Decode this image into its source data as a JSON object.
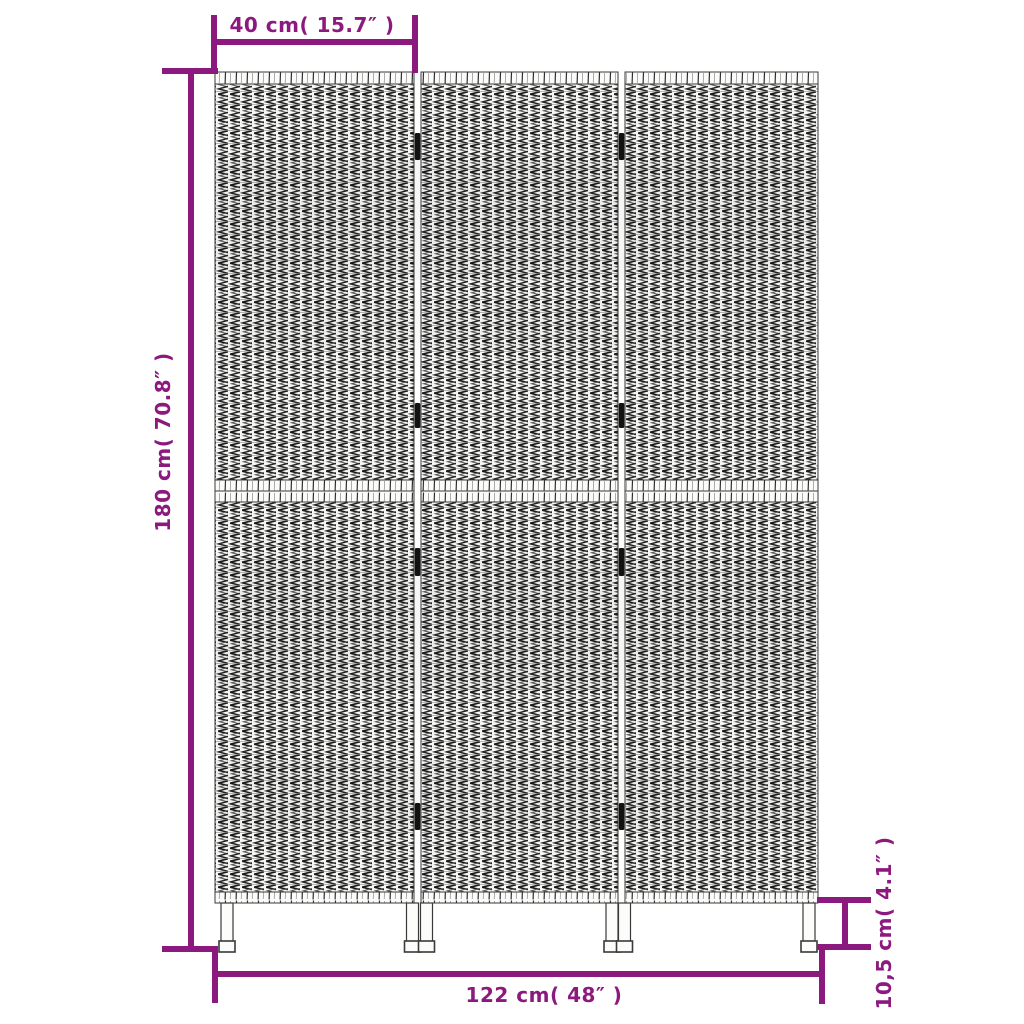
{
  "accent_color": "#8c1a7e",
  "background_color": "#ffffff",
  "labels": {
    "panel_width": "40 cm( 15.7″ )",
    "height": "180 cm( 70.8″ )",
    "total_width": "122 cm( 48″ )",
    "leg_height": "10,5 cm( 4.1″ )"
  },
  "illustration": {
    "subject": "three-panel woven room divider",
    "panels": 3,
    "sections_per_panel": 2,
    "legs": 6,
    "hinges": 8,
    "weave_color": "#1b1b1b",
    "frame_color": "#3a3a3a"
  }
}
